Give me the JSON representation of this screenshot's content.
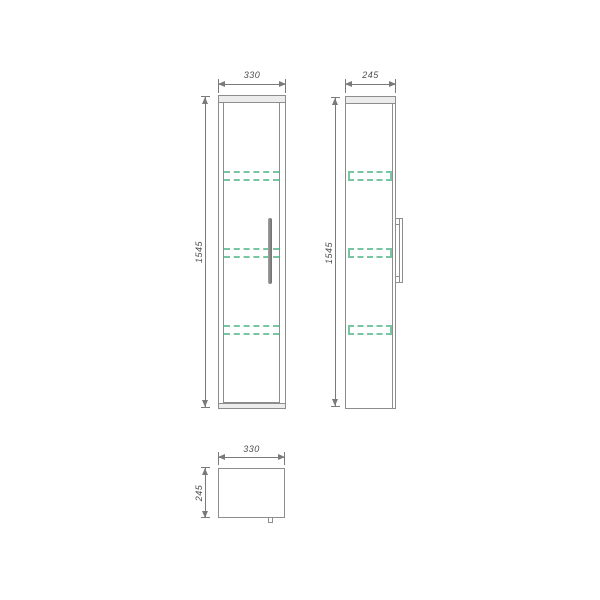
{
  "drawing": {
    "front_view": {
      "width_label": "330",
      "height_label": "1545"
    },
    "side_view": {
      "width_label": "245",
      "height_label": "1545"
    },
    "top_view": {
      "width_label": "330",
      "depth_label": "245"
    }
  },
  "colors": {
    "shelf_green": "#76c7a1",
    "line_gray": "#8d8d8d",
    "dim_gray": "#7a7a7a",
    "text_gray": "#4e4e4e",
    "band_fill": "#ececec",
    "handle_dark": "#6f6f6f",
    "background": "#ffffff"
  }
}
